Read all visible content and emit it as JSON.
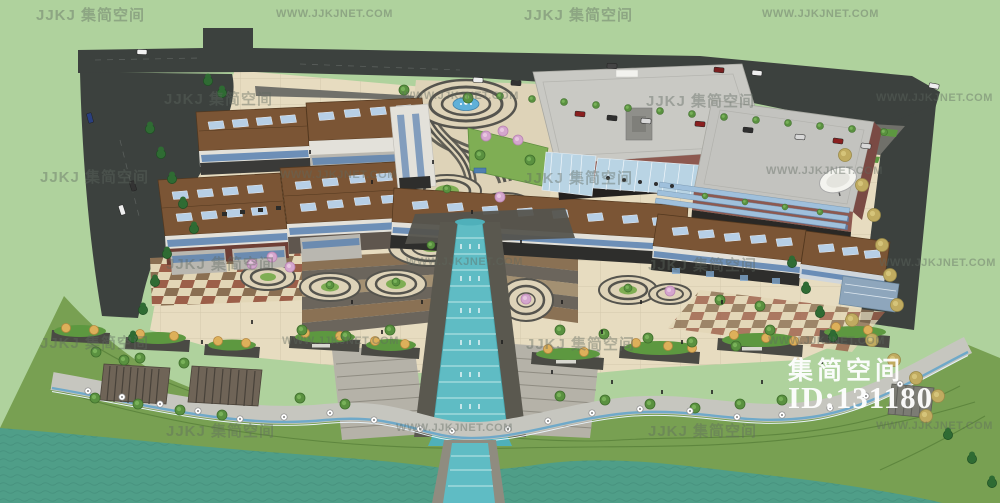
{
  "watermark": {
    "brand_label": "JJKJ 集简空间",
    "url_label": "WWW.JJKJNET.COM",
    "grid": [
      [
        36,
        4,
        "brand"
      ],
      [
        276,
        8,
        "url"
      ],
      [
        524,
        4,
        "brand"
      ],
      [
        762,
        8,
        "url"
      ],
      [
        164,
        88,
        "brand"
      ],
      [
        402,
        90,
        "url"
      ],
      [
        646,
        90,
        "brand"
      ],
      [
        876,
        92,
        "url"
      ],
      [
        40,
        166,
        "brand"
      ],
      [
        280,
        169,
        "url"
      ],
      [
        524,
        167,
        "brand"
      ],
      [
        766,
        165,
        "url"
      ],
      [
        166,
        253,
        "brand"
      ],
      [
        406,
        256,
        "url"
      ],
      [
        648,
        254,
        "brand"
      ],
      [
        879,
        257,
        "url"
      ],
      [
        40,
        332,
        "brand"
      ],
      [
        282,
        335,
        "url"
      ],
      [
        526,
        333,
        "brand"
      ],
      [
        768,
        335,
        "url"
      ],
      [
        166,
        420,
        "brand"
      ],
      [
        396,
        422,
        "url"
      ],
      [
        648,
        420,
        "brand"
      ],
      [
        876,
        420,
        "url"
      ]
    ]
  },
  "overlay": {
    "brand": "集简空间",
    "model_id": "ID:131180"
  },
  "palette": {
    "background": "#afd29d",
    "road": "#3c413e",
    "asphalt": "#70706a",
    "plaza": "#e7dcc0",
    "plaza_line": "#cfc5a8",
    "checker_a": "#8a6f52",
    "checker_b": "#9c5f49",
    "checker_base": "#e2d6b6",
    "ring_dark": "#55544e",
    "ring_light": "#ded3b8",
    "lawn": "#7fae54",
    "roof_brown": "#7b5535",
    "roof_edge": "#53381f",
    "solar_panel": "#b7cfe6",
    "window_blue": "#5880b0",
    "wall_white": "#e3e1da",
    "storefront": "#2e2e2c",
    "big_roof": "#c9c9c4",
    "wall_maroon": "#8d5950",
    "glass": "#b9d4e4",
    "cascade": "#5fbcc4",
    "fountain": "#5fb0d8",
    "lake": "#4f9e88",
    "lake_line": "#3f8573",
    "bank": "#78a052",
    "bank_line": "#587f39",
    "promenade": "#c6c6bf",
    "promenade_stripe": "#6fa9c9",
    "hedge": "#5d9840",
    "tree_green": "#5a9140",
    "tree_dark": "#2f6b33",
    "tree_yellow": "#c0ab60",
    "blossom": "#d4a6ce",
    "umbrella": "#ddb05a",
    "pergola": "#6f6457",
    "step_gray": "#b5b2a8",
    "step_line": "#8f8c82",
    "terrace_brown": "#8a7154",
    "terrace_gray": "#6b655c",
    "terrace_light": "#a39072",
    "watermark_color": "rgba(96,106,96,0.42)",
    "overlay_text": "#ffffff"
  }
}
